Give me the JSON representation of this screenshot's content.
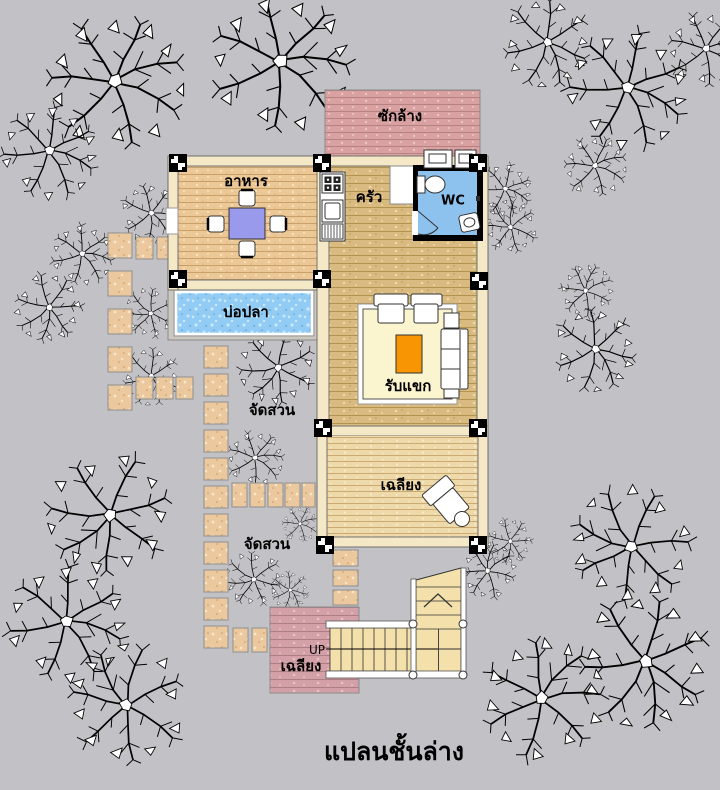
{
  "title": "แปลนชั้นล่าง",
  "labels": {
    "laundry": "ซักล้าง",
    "dining": "อาหาร",
    "kitchen": "ครัว",
    "wc": "WC",
    "fish_pond": "บ่อปลา",
    "living": "รับแขก",
    "garden_upper": "จัดสวน",
    "garden_lower": "จัดสวน",
    "terrace_upper": "เฉลียง",
    "terrace_lower": "เฉลียง",
    "stairs_direction": "UP"
  },
  "colors": {
    "background": "#c2c2c6",
    "dining_floor": "#ecc897",
    "hall_floor": "#d9ba80",
    "terrace_floor": "#eed9ab",
    "laundry_brick": "#d9a1a1",
    "lower_terrace_brick": "#d2a0a6",
    "pond_water": "#92ccf4",
    "wc_tile": "#8ec2ee",
    "wall_cream": "#f4e8c7",
    "stepping_stone": "#ebc89e",
    "stair_tread": "#f3e0ab",
    "dining_table": "#9a9aec",
    "coffee_table": "#f79503"
  },
  "elements": {
    "tree_icon": "plan-tree",
    "column_icon": "column-marker",
    "stove_icon": "four-burner-stove",
    "sink_icon": "kitchen-sink",
    "toilet_icon": "toilet",
    "washer_icon": "washing-machine",
    "up_arrow_icon": "stair-direction-chevron"
  }
}
